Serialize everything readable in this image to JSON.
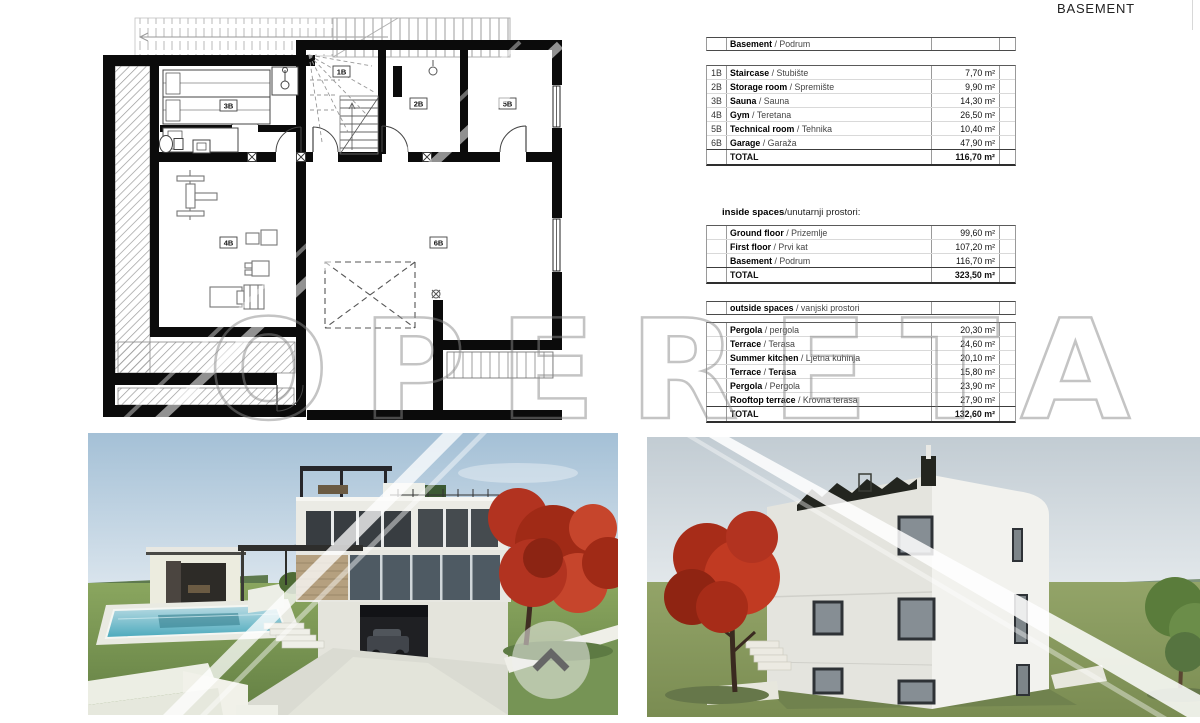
{
  "page": {
    "title": "BASEMENT"
  },
  "watermark": {
    "text": "OPERETA"
  },
  "colors": {
    "wall_black": "#0b0b0b",
    "watermark_gray": "#8a8a8a",
    "pool_teal": "#4aa9bc",
    "grass_green": "#84a15c",
    "sky_blue": "#a4c0d6",
    "tree_red": "#b23320"
  },
  "plan": {
    "rooms": {
      "r1b": "1B",
      "r2b": "2B",
      "r3b": "3B",
      "r4b": "4B",
      "r5b": "5B",
      "r6b": "6B"
    }
  },
  "tables": {
    "sep": " / ",
    "basement": {
      "header_en": "Basement",
      "header_hr": "Podrum",
      "rows": [
        {
          "code": "1B",
          "en": "Staircase",
          "hr": "Stubište",
          "value": "7,70 m²"
        },
        {
          "code": "2B",
          "en": "Storage room",
          "hr": "Spremište",
          "value": "9,90 m²"
        },
        {
          "code": "3B",
          "en": "Sauna",
          "hr": "Sauna",
          "value": "14,30 m²"
        },
        {
          "code": "4B",
          "en": "Gym",
          "hr": "Teretana",
          "value": "26,50 m²"
        },
        {
          "code": "5B",
          "en": "Technical room",
          "hr": "Tehnika",
          "value": "10,40 m²"
        },
        {
          "code": "6B",
          "en": "Garage",
          "hr": "Garaža",
          "value": "47,90 m²"
        }
      ],
      "total_label": "TOTAL",
      "total_value": "116,70 m²"
    },
    "inside": {
      "title_bold": "inside spaces",
      "title_rest": "/unutarnji prostori:",
      "rows": [
        {
          "en": "Ground floor",
          "hr": "Prizemlje",
          "value": "99,60 m²"
        },
        {
          "en": "First floor",
          "hr": "Prvi kat",
          "value": "107,20 m²"
        },
        {
          "en": "Basement",
          "hr": "Podrum",
          "value": "116,70 m²"
        }
      ],
      "total_label": "TOTAL",
      "total_value": "323,50 m²"
    },
    "outside": {
      "header_bold": "outside spaces",
      "header_rest": "vanjski prostori",
      "rows": [
        {
          "en": "Pergola",
          "hr": "pergola",
          "value": "20,30 m²"
        },
        {
          "en": "Terrace",
          "hr": "Terasa",
          "value": "24,60 m²"
        },
        {
          "en": "Summer kitchen",
          "hr": "Ljetna kuhinja",
          "value": "20,10 m²"
        },
        {
          "en": "Terrace",
          "hr": "Terasa",
          "value": "15,80 m²",
          "bold_hr": true
        },
        {
          "en": "Pergola",
          "hr": "Pergola",
          "value": "23,90 m²"
        },
        {
          "en": "Rooftop terrace",
          "hr": "Krovna terasa",
          "value": "27,90 m²"
        }
      ],
      "total_label": "TOTAL",
      "total_value": "132,60 m²"
    }
  }
}
